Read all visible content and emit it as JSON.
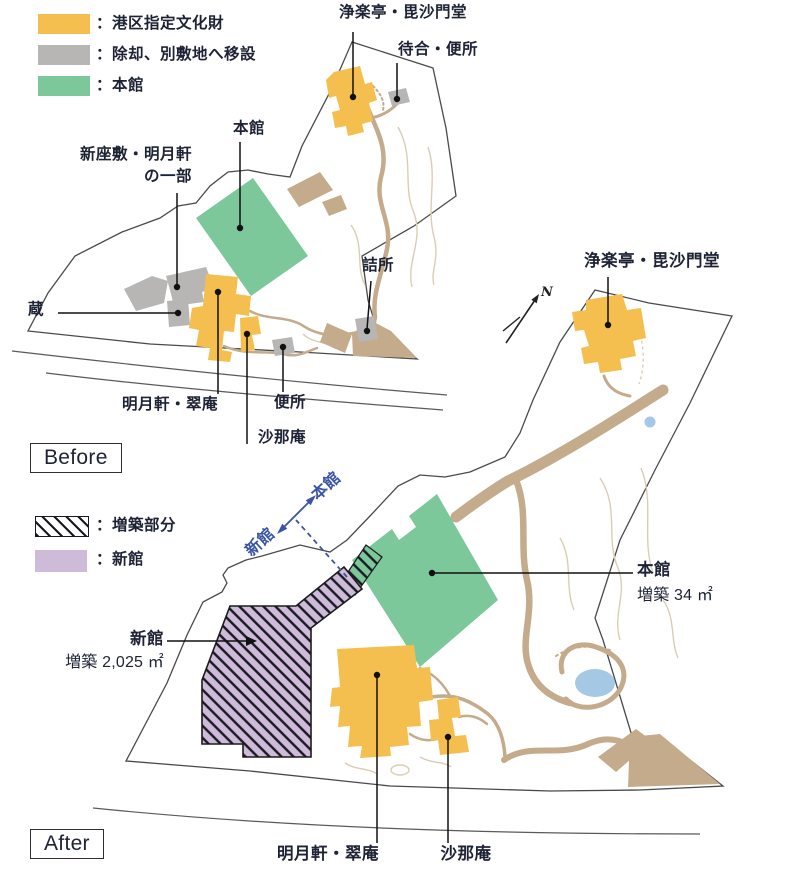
{
  "colors": {
    "cultural": "#F5BF4F",
    "removed": "#B7B6B4",
    "honkan": "#7DC89B",
    "shinkan": "#CEBAD9",
    "path": "#C3AB8B",
    "pathlight": "#DBCDB5",
    "pond": "#A5C8E4",
    "ink": "#1D2335",
    "blue": "#3A54A5",
    "line": "#4A4A4A"
  },
  "legend_before": {
    "items": [
      {
        "label": "：港区指定文化財",
        "swatch": "cultural"
      },
      {
        "label": "：除却、別敷地へ移設",
        "swatch": "removed"
      },
      {
        "label": "：本館",
        "swatch": "honkan"
      }
    ]
  },
  "legend_after": {
    "items": [
      {
        "label": "：増築部分",
        "swatch": "hatch"
      },
      {
        "label": "：新館",
        "swatch": "shinkan"
      }
    ]
  },
  "before": {
    "tag": "Before",
    "labels": {
      "joraku": "浄楽亭・毘沙門堂",
      "machiai": "待合・便所",
      "honkan": "本館",
      "shinzashiki1": "新座敷・明月軒",
      "shinzashiki2": "の一部",
      "kura": "蔵",
      "meigetsuken": "明月軒・翠庵",
      "benjo": "便所",
      "shanaan": "沙那庵",
      "tsumesho": "詰所"
    }
  },
  "after": {
    "tag": "After",
    "labels": {
      "joraku": "浄楽亭・毘沙門堂",
      "honkan": "本館",
      "honkan_note": "増築 34 ㎡",
      "shinkan": "新館",
      "shinkan_note": "増築 2,025 ㎡",
      "meigetsuken": "明月軒・翠庵",
      "shanaan": "沙那庵"
    },
    "corridor": {
      "left": "新館",
      "right": "本館"
    }
  },
  "compass": {
    "north": "N"
  }
}
